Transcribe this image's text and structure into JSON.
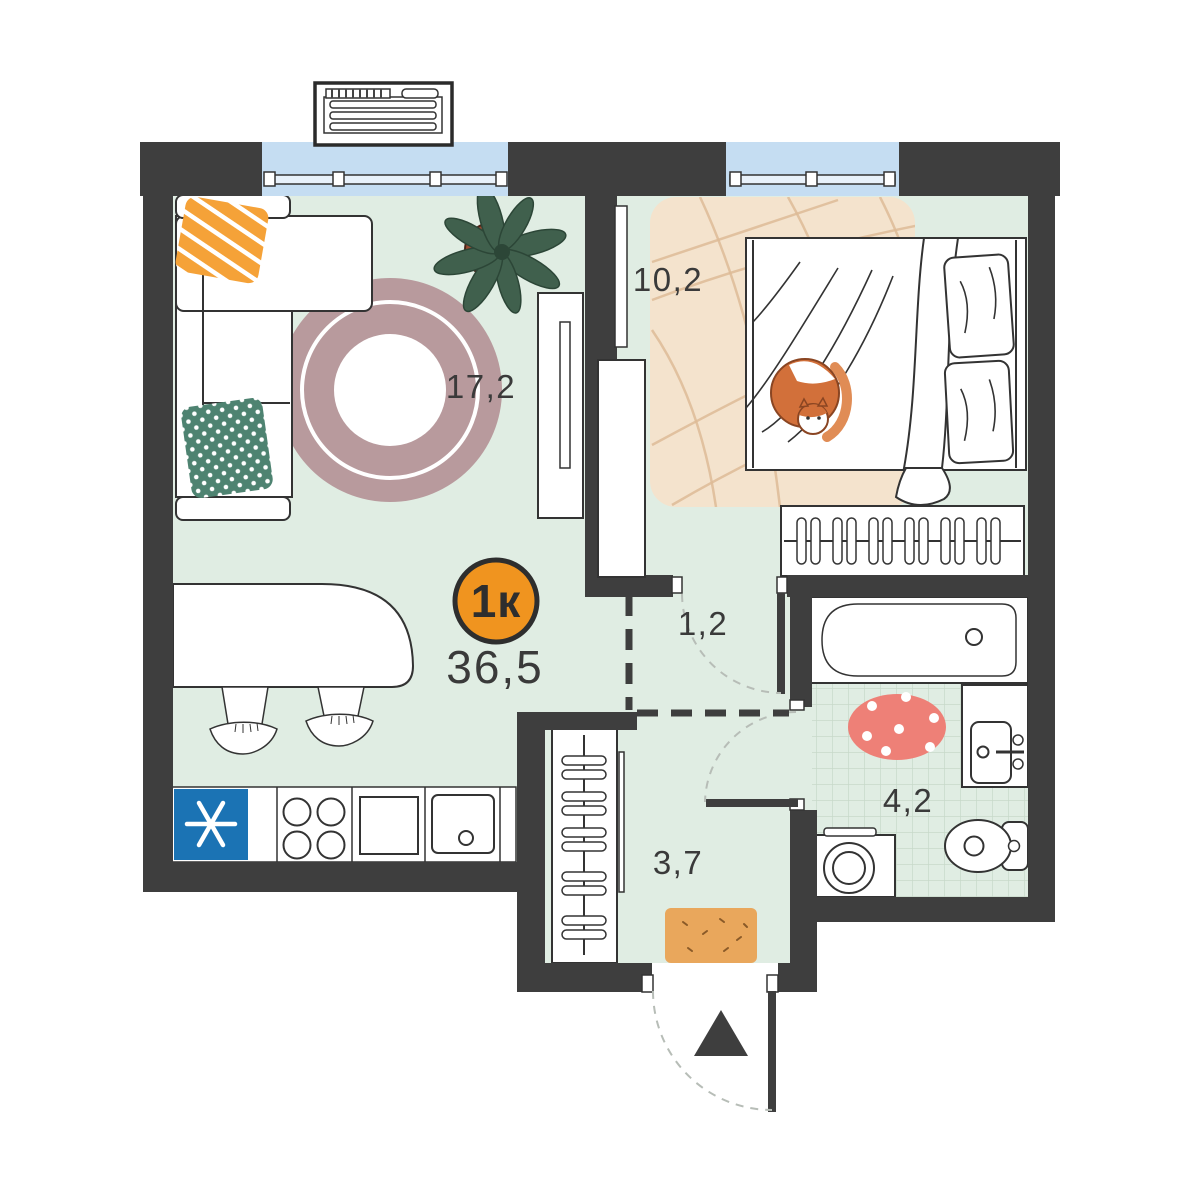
{
  "plan": {
    "badge": {
      "label": "1к"
    },
    "total_area": "36,5",
    "areas": {
      "living": "17,2",
      "bedroom": "10,2",
      "hallway": "1,2",
      "bathroom": "4,2",
      "entry": "3,7"
    },
    "colors": {
      "wall": "#3e3e3e",
      "line": "#333333",
      "floor": "#e0ede3",
      "tile_line": "#c7d9c9",
      "window_glass": "#c5ddf2",
      "window_sill": "#e8f1fa",
      "carpet": "#f4e3cd",
      "carpet_line": "#ddbb97",
      "rug": "#b89a9d",
      "badge": "#f0941f",
      "fridge": "#1b73b4",
      "bath_rug": "#ee8077",
      "doormat": "#e9a75c",
      "pillow_orange": "#f5a238",
      "pillow_teal": "#4e8371",
      "plant": "#40604d",
      "plant_dark": "#2c4637",
      "plant_pot": "#9a4a30",
      "cat": "#d2703a",
      "cat_tail": "#e08c55",
      "arc": "#b7bdb7"
    }
  }
}
